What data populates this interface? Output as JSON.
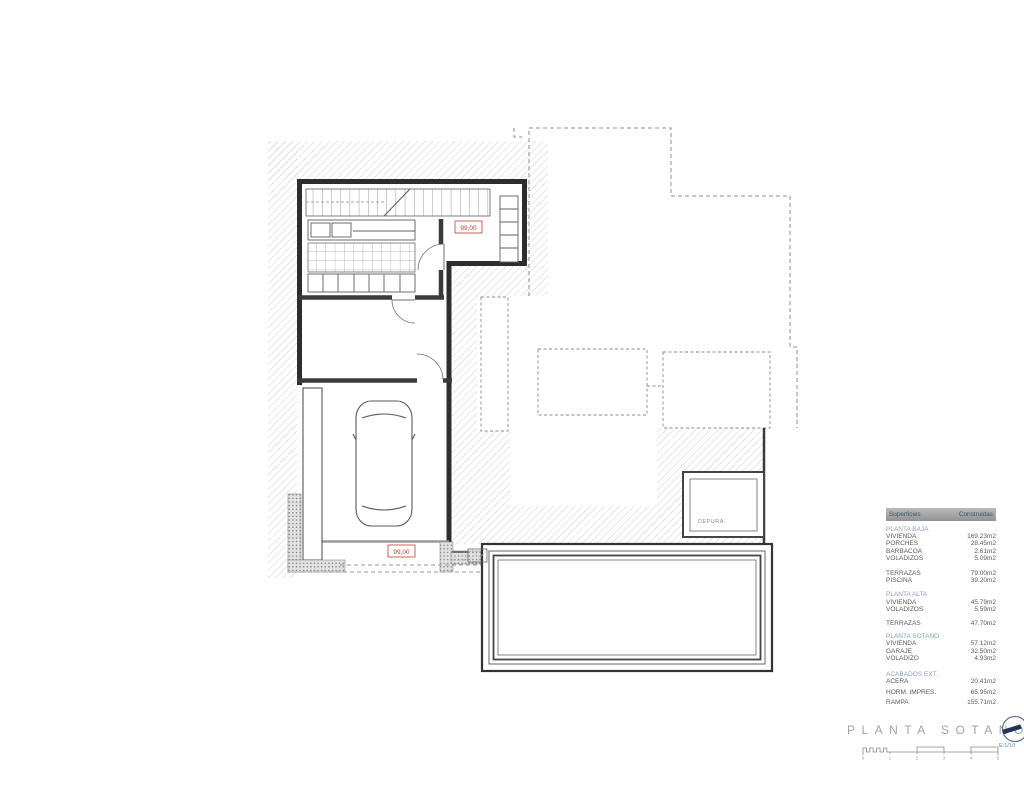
{
  "plan": {
    "level_labels": {
      "upper": "99,00",
      "lower": "99,00"
    },
    "rooms": {
      "depura": "DEPURA."
    }
  },
  "areas_table": {
    "header": {
      "left": "Superficies",
      "right": "Construidas"
    },
    "blocks": [
      {
        "title": "PLANTA BAJA",
        "rows": [
          {
            "label": "VIVIENDA",
            "value": "169.23m2"
          },
          {
            "label": "PORCHES",
            "value": "28.45m2"
          },
          {
            "label": "BARBACOA",
            "value": "2.61m2"
          },
          {
            "label": "VOLADIZOS",
            "value": "5.09m2"
          }
        ]
      },
      {
        "title": "",
        "rows": [
          {
            "label": "TERRAZAS",
            "value": "79.00m2"
          },
          {
            "label": "PISCINA",
            "value": "39.20m2"
          }
        ]
      },
      {
        "title": "PLANTA ALTA",
        "rows": [
          {
            "label": "VIVIENDA",
            "value": "45.79m2"
          },
          {
            "label": "VOLADIZOS",
            "value": "5.59m2"
          }
        ]
      },
      {
        "title": "",
        "rows": [
          {
            "label": "TERRAZAS",
            "value": "47.70m2"
          }
        ]
      },
      {
        "title": "PLANTA SOTANO",
        "rows": [
          {
            "label": "VIVIENDA",
            "value": "57.12m2"
          },
          {
            "label": "GARAJE",
            "value": "32.50m2"
          },
          {
            "label": "VOLADIZO",
            "value": "4.93m2"
          }
        ]
      },
      {
        "title": "ACABADOS EXT.",
        "rows": [
          {
            "label": "ACERA",
            "value": "20.41m2"
          },
          {
            "label": "HORM. IMPRES.",
            "value": "65.95m2"
          },
          {
            "label": "RAMPA",
            "value": "155.71m2"
          }
        ]
      }
    ]
  },
  "title_block": {
    "title": "PLANTA SOTANO",
    "scale_label": "E:1/10",
    "ticks": [
      "0",
      "1",
      "2",
      "3",
      "4",
      "5"
    ]
  },
  "colors": {
    "accent_red": "#b0423a",
    "section_blue": "#8d9cb8",
    "navy": "#1d3557",
    "scale_blue": "#5b87b8"
  }
}
